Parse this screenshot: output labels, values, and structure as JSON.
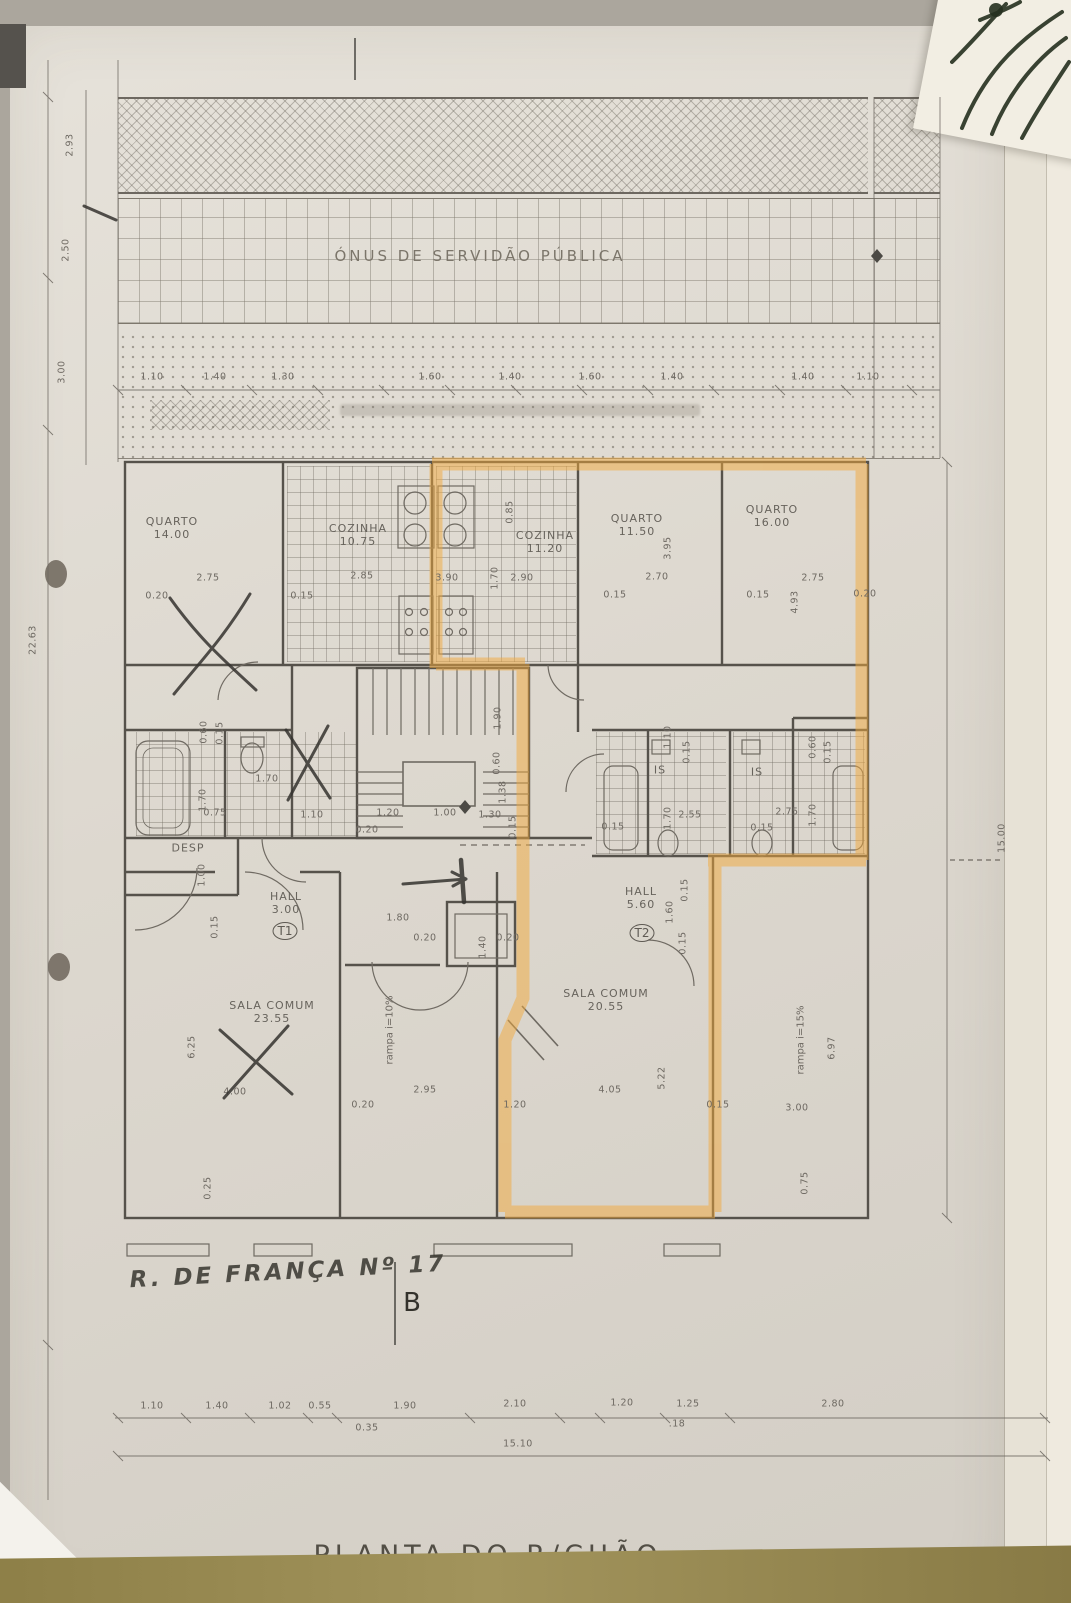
{
  "document": {
    "servitude_label": "ÓNUS DE SERVIDÃO PÚBLICA",
    "plan_title": "PLANTA DO R/CHÃO",
    "street_note": "R. DE FRANÇA Nº 17",
    "section_letter": "B"
  },
  "colors": {
    "highlight": "#f2a93c",
    "paper": "#dcd7ce",
    "band_olive": "#93854d"
  },
  "rooms": [
    {
      "name": "QUARTO",
      "area": "14.00",
      "x": 172,
      "y": 528
    },
    {
      "name": "COZINHA",
      "area": "10.75",
      "x": 358,
      "y": 535
    },
    {
      "name": "COZINHA",
      "area": "11.20",
      "x": 545,
      "y": 542
    },
    {
      "name": "QUARTO",
      "area": "11.50",
      "x": 637,
      "y": 525
    },
    {
      "name": "QUARTO",
      "area": "16.00",
      "x": 772,
      "y": 516
    },
    {
      "name": "DESP",
      "area": "",
      "x": 188,
      "y": 848
    },
    {
      "name": "IS",
      "area": "",
      "x": 660,
      "y": 770
    },
    {
      "name": "IS",
      "area": "",
      "x": 757,
      "y": 772
    },
    {
      "name": "HALL",
      "area": "3.00",
      "x": 286,
      "y": 903
    },
    {
      "name": "HALL",
      "area": "5.60",
      "x": 641,
      "y": 898
    },
    {
      "name": "SALA COMUM",
      "area": "23.55",
      "x": 272,
      "y": 1012
    },
    {
      "name": "SALA COMUM",
      "area": "20.55",
      "x": 606,
      "y": 1000
    }
  ],
  "units": [
    {
      "label": "T1",
      "x": 285,
      "y": 931
    },
    {
      "label": "T2",
      "x": 642,
      "y": 933
    }
  ],
  "ramps": [
    {
      "label": "rampa i=10%",
      "x": 390,
      "y": 1030
    },
    {
      "label": "rampa i=15%",
      "x": 801,
      "y": 1040
    }
  ],
  "dims": [
    {
      "t": "1.10",
      "x": 152,
      "y": 377
    },
    {
      "t": "1.40",
      "x": 215,
      "y": 377
    },
    {
      "t": "1.30",
      "x": 283,
      "y": 377
    },
    {
      "t": "1.60",
      "x": 430,
      "y": 377
    },
    {
      "t": "1.40",
      "x": 510,
      "y": 377
    },
    {
      "t": "1.60",
      "x": 590,
      "y": 377
    },
    {
      "t": "1.40",
      "x": 672,
      "y": 377
    },
    {
      "t": "1.40",
      "x": 803,
      "y": 377
    },
    {
      "t": "1.10",
      "x": 868,
      "y": 377
    },
    {
      "t": "0.20",
      "x": 157,
      "y": 596
    },
    {
      "t": "2.75",
      "x": 208,
      "y": 578
    },
    {
      "t": "0.15",
      "x": 302,
      "y": 596
    },
    {
      "t": "2.85",
      "x": 362,
      "y": 576
    },
    {
      "t": "3.90",
      "x": 447,
      "y": 578
    },
    {
      "t": "0.85",
      "x": 510,
      "y": 512,
      "v": 1
    },
    {
      "t": "1.70",
      "x": 495,
      "y": 578,
      "v": 1
    },
    {
      "t": "2.90",
      "x": 522,
      "y": 578
    },
    {
      "t": "0.15",
      "x": 615,
      "y": 595
    },
    {
      "t": "2.70",
      "x": 657,
      "y": 577
    },
    {
      "t": "3.95",
      "x": 668,
      "y": 548,
      "v": 1
    },
    {
      "t": "0.15",
      "x": 758,
      "y": 595
    },
    {
      "t": "2.75",
      "x": 813,
      "y": 578
    },
    {
      "t": "0.20",
      "x": 865,
      "y": 594
    },
    {
      "t": "4.93",
      "x": 795,
      "y": 602,
      "v": 1
    },
    {
      "t": "0.60",
      "x": 204,
      "y": 732,
      "v": 1
    },
    {
      "t": "0.15",
      "x": 220,
      "y": 733,
      "v": 1
    },
    {
      "t": "1.70",
      "x": 267,
      "y": 779
    },
    {
      "t": "1.70",
      "x": 203,
      "y": 800,
      "v": 1
    },
    {
      "t": "0.75",
      "x": 215,
      "y": 813
    },
    {
      "t": "1.10",
      "x": 312,
      "y": 815
    },
    {
      "t": "0.20",
      "x": 367,
      "y": 830
    },
    {
      "t": "1.90",
      "x": 498,
      "y": 718,
      "v": 1
    },
    {
      "t": "0.60",
      "x": 497,
      "y": 763,
      "v": 1
    },
    {
      "t": "1.38",
      "x": 503,
      "y": 792,
      "v": 1
    },
    {
      "t": "1.20",
      "x": 388,
      "y": 813
    },
    {
      "t": "1.00",
      "x": 445,
      "y": 813
    },
    {
      "t": "1.30",
      "x": 490,
      "y": 815
    },
    {
      "t": "0.15",
      "x": 513,
      "y": 827,
      "v": 1
    },
    {
      "t": "1.10",
      "x": 668,
      "y": 737,
      "v": 1
    },
    {
      "t": "0.15",
      "x": 687,
      "y": 752,
      "v": 1
    },
    {
      "t": "0.60",
      "x": 813,
      "y": 747,
      "v": 1
    },
    {
      "t": "0.15",
      "x": 828,
      "y": 752,
      "v": 1
    },
    {
      "t": "1.70",
      "x": 668,
      "y": 818,
      "v": 1
    },
    {
      "t": "2.55",
      "x": 690,
      "y": 815
    },
    {
      "t": "2.75",
      "x": 787,
      "y": 812
    },
    {
      "t": "1.70",
      "x": 813,
      "y": 815,
      "v": 1
    },
    {
      "t": "0.15",
      "x": 613,
      "y": 827
    },
    {
      "t": "0.15",
      "x": 762,
      "y": 828
    },
    {
      "t": "1.00",
      "x": 202,
      "y": 875,
      "v": 1
    },
    {
      "t": "0.15",
      "x": 215,
      "y": 927,
      "v": 1
    },
    {
      "t": "1.80",
      "x": 398,
      "y": 918
    },
    {
      "t": "0.20",
      "x": 425,
      "y": 938
    },
    {
      "t": "1.40",
      "x": 483,
      "y": 947,
      "v": 1
    },
    {
      "t": "0.20",
      "x": 508,
      "y": 938
    },
    {
      "t": "1.60",
      "x": 670,
      "y": 912,
      "v": 1
    },
    {
      "t": "0.15",
      "x": 685,
      "y": 890,
      "v": 1
    },
    {
      "t": "0.15",
      "x": 683,
      "y": 943,
      "v": 1
    },
    {
      "t": "6.25",
      "x": 192,
      "y": 1047,
      "v": 1
    },
    {
      "t": "4.00",
      "x": 235,
      "y": 1092
    },
    {
      "t": "0.20",
      "x": 363,
      "y": 1105
    },
    {
      "t": "2.95",
      "x": 425,
      "y": 1090
    },
    {
      "t": "1.20",
      "x": 515,
      "y": 1105
    },
    {
      "t": "4.05",
      "x": 610,
      "y": 1090
    },
    {
      "t": "5.22",
      "x": 662,
      "y": 1078,
      "v": 1
    },
    {
      "t": "0.15",
      "x": 718,
      "y": 1105
    },
    {
      "t": "3.00",
      "x": 797,
      "y": 1108
    },
    {
      "t": "6.97",
      "x": 832,
      "y": 1048,
      "v": 1
    },
    {
      "t": "0.25",
      "x": 208,
      "y": 1188,
      "v": 1
    },
    {
      "t": "0.75",
      "x": 805,
      "y": 1183,
      "v": 1
    },
    {
      "t": "2.93",
      "x": 70,
      "y": 145,
      "v": 1
    },
    {
      "t": "2.50",
      "x": 66,
      "y": 250,
      "v": 1
    },
    {
      "t": "3.00",
      "x": 62,
      "y": 372,
      "v": 1
    },
    {
      "t": "22.63",
      "x": 33,
      "y": 640,
      "v": 1
    },
    {
      "t": "15.00",
      "x": 1002,
      "y": 838,
      "v": 1
    },
    {
      "t": "1.10",
      "x": 152,
      "y": 1406
    },
    {
      "t": "1.40",
      "x": 217,
      "y": 1406
    },
    {
      "t": "1.02",
      "x": 280,
      "y": 1406
    },
    {
      "t": "0.55",
      "x": 320,
      "y": 1406
    },
    {
      "t": "1.90",
      "x": 405,
      "y": 1406
    },
    {
      "t": "2.10",
      "x": 515,
      "y": 1404
    },
    {
      "t": "1.20",
      "x": 622,
      "y": 1403
    },
    {
      "t": "1.25",
      "x": 688,
      "y": 1404
    },
    {
      "t": "2.80",
      "x": 833,
      "y": 1404
    },
    {
      "t": "0.35",
      "x": 367,
      "y": 1428
    },
    {
      "t": ".18",
      "x": 677,
      "y": 1424
    },
    {
      "t": "15.10",
      "x": 518,
      "y": 1444
    }
  ]
}
